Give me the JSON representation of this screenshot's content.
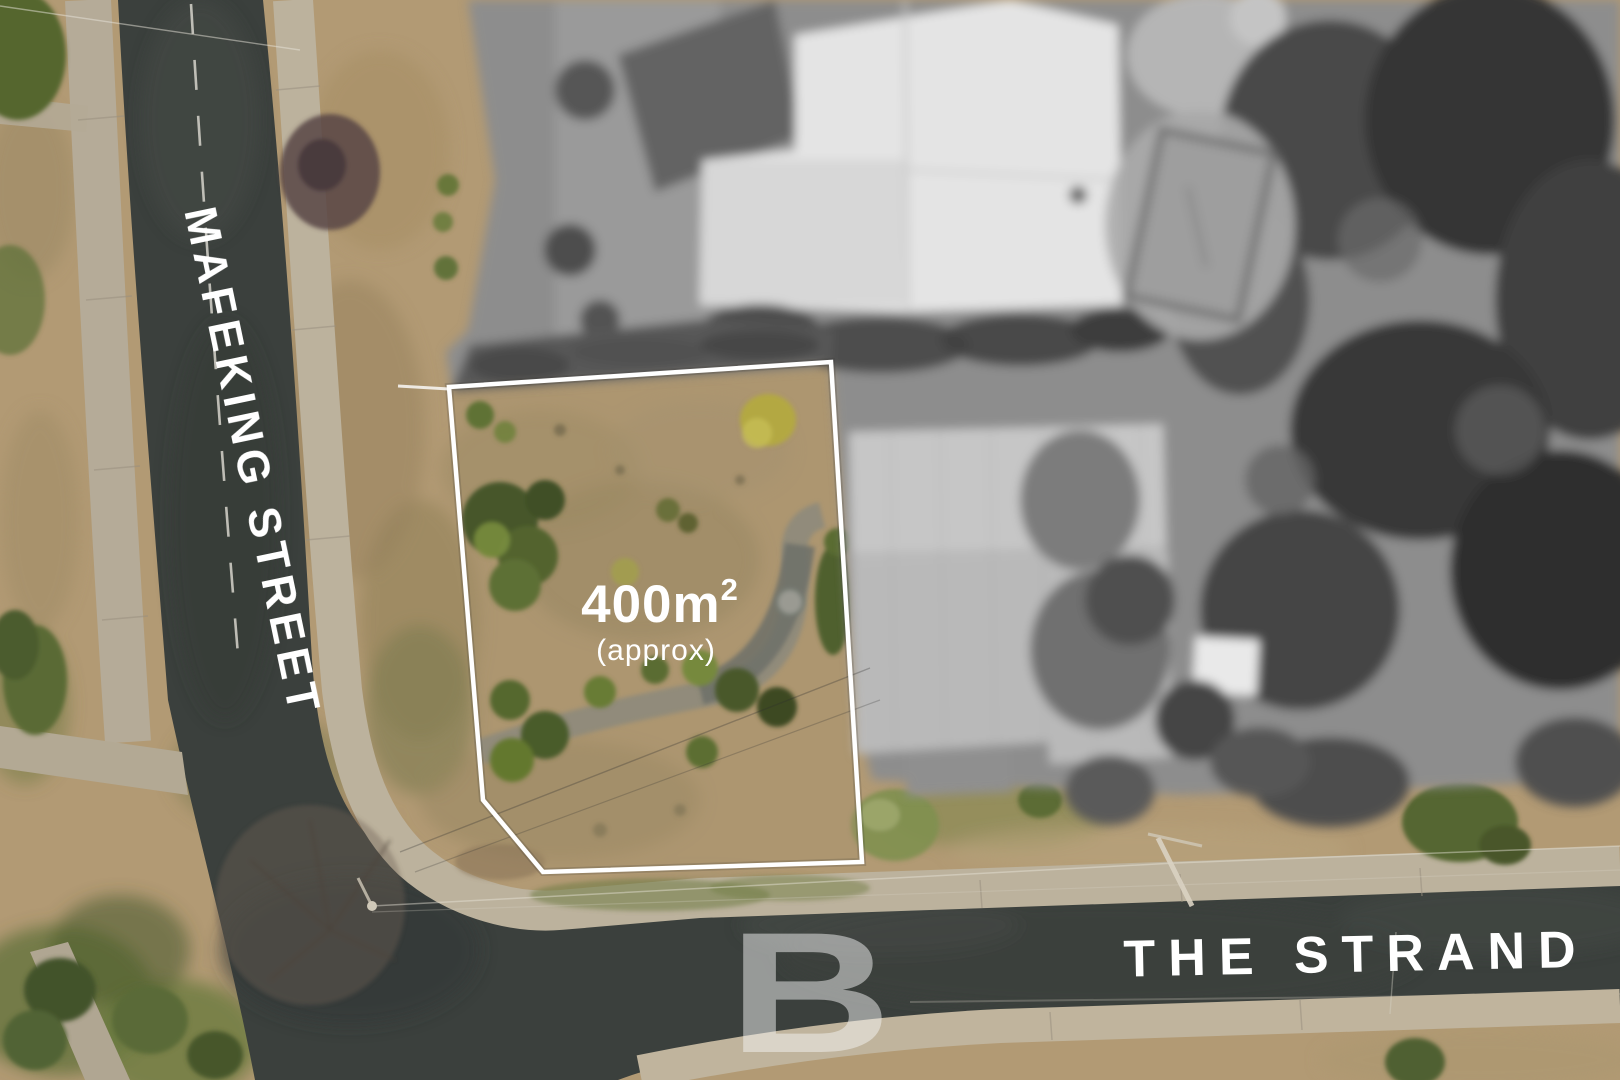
{
  "scene": {
    "type": "aerial-drone-photo",
    "subject": "vacant corner block of land outlined for sale at Mafeking Street and The Strand",
    "property": {
      "area_value": "400m",
      "area_superscript": "2",
      "area_qualifier": "(approx)",
      "boundary_color": "#ffffff"
    },
    "streets": {
      "vertical_label": "MAFEKING STREET",
      "horizontal_label": "THE STRAND"
    },
    "watermark": {
      "letter": "B",
      "style": "translucent-white"
    },
    "palette": {
      "road_asphalt": "#3b403d",
      "dry_grass": "#b29a74",
      "concrete_path": "#b8ae9b",
      "greenery": "#55662f",
      "desaturated_neighbors": "#8d8d8d",
      "label_text": "#ffffff"
    }
  }
}
